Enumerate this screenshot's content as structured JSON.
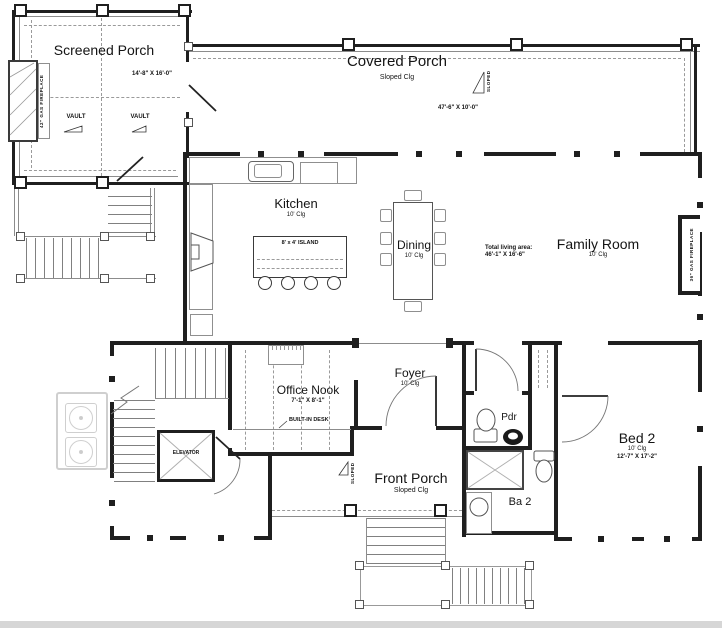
{
  "rooms": {
    "screened_porch": {
      "name": "Screened Porch",
      "dims": "14'-8\" X 16'-0\""
    },
    "covered_porch": {
      "name": "Covered Porch",
      "clg": "Sloped Clg",
      "dims": "47'-6\" X 10'-0\""
    },
    "kitchen": {
      "name": "Kitchen",
      "clg": "10' Clg"
    },
    "dining": {
      "name": "Dining",
      "clg": "10' Clg"
    },
    "family_room": {
      "name": "Family Room",
      "clg": "10' Clg"
    },
    "office_nook": {
      "name": "Office Nook",
      "dims": "7'-1\" X 8'-1\""
    },
    "foyer": {
      "name": "Foyer",
      "clg": "10' Clg"
    },
    "front_porch": {
      "name": "Front Porch",
      "clg": "Sloped Clg"
    },
    "pdr": {
      "name": "Pdr"
    },
    "ba2": {
      "name": "Ba 2"
    },
    "bed2": {
      "name": "Bed 2",
      "clg": "10' Clg",
      "dims": "12'-7\" X 17'-2\""
    }
  },
  "fixtures": {
    "island": "8' x 4' ISLAND",
    "built_in_desk": "BUILT-IN DESK",
    "elevator": "ELEVATOR"
  },
  "annotations": {
    "vault": "VAULT",
    "sloped": "SLOPED",
    "fireplace_42": "42\" GAS FIREPLACE",
    "fireplace_36": "36\" GAS FIREPLACE",
    "total_living_area": "Total living area:",
    "total_living_dims": "46'-1\" X 16'-6\""
  },
  "colors": {
    "wall": "#1f1f1f",
    "thin": "#8c8c8c",
    "dash": "#9a9a9a",
    "fx": "#8f8f8f",
    "light": "#cfcfcf",
    "paper": "#ffffff"
  }
}
